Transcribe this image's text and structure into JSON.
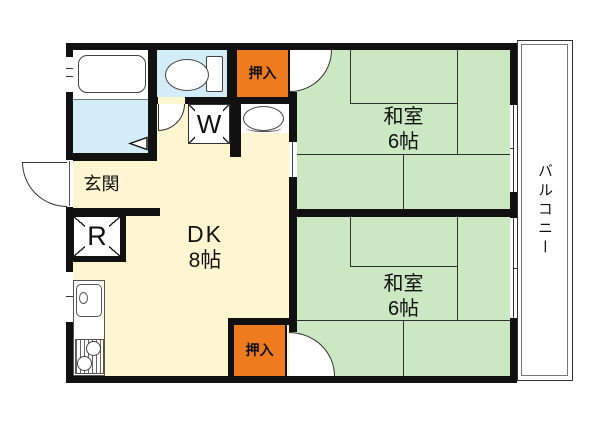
{
  "plan": {
    "type": "apartment-floor-plan",
    "unit_layout": "2DK"
  },
  "colors": {
    "wall": "#111111",
    "line": "#2f2f2f",
    "tatami": "#cbe8c3",
    "dk": "#fdf6d1",
    "wet": "#d2ecf8",
    "genkan": "#b9b9b9",
    "closet": "#ee7b1d"
  },
  "rooms": {
    "washitsu_top": {
      "name": "和室",
      "size": "6帖"
    },
    "washitsu_bottom": {
      "name": "和室",
      "size": "6帖"
    },
    "dk": {
      "name": "DK",
      "size": "8帖"
    },
    "balcony": {
      "name": "バルコニー"
    },
    "genkan": {
      "name": "玄関"
    },
    "closet_top": {
      "name": "押入"
    },
    "closet_bottom": {
      "name": "押入"
    }
  },
  "appliances": {
    "washer": "W",
    "refrigerator": "R"
  }
}
